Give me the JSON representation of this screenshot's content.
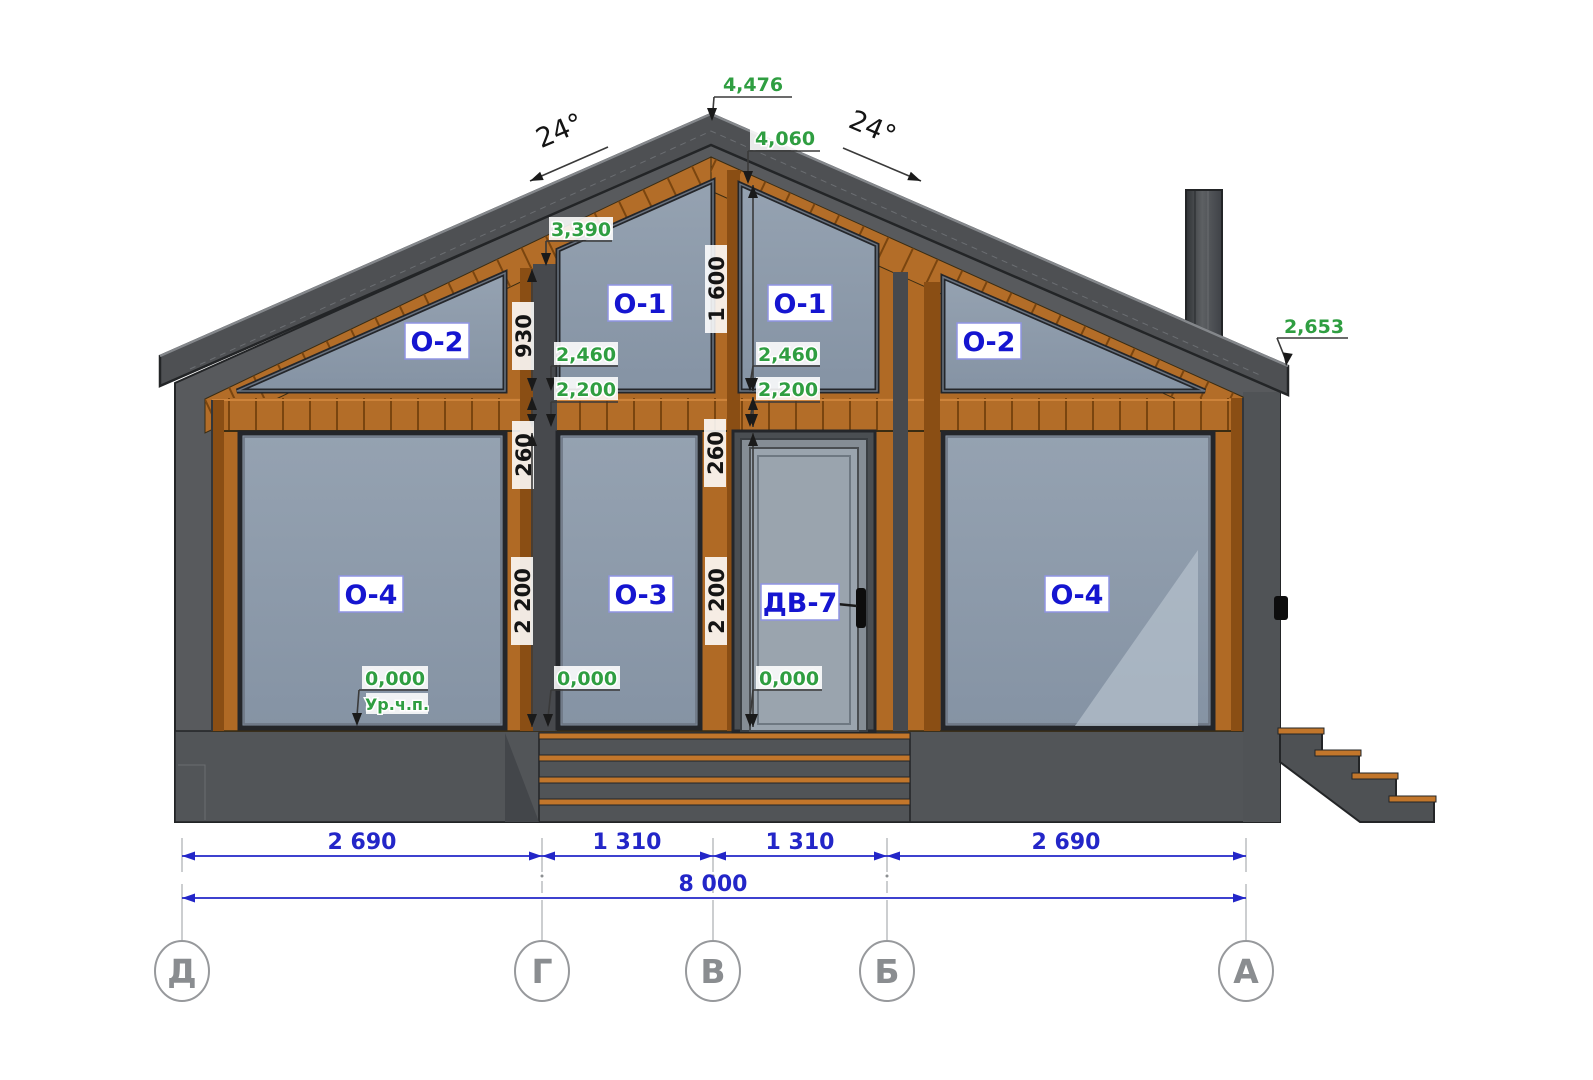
{
  "drawing": {
    "type": "house facade elevation",
    "slopes": {
      "left": "24°",
      "right": "24°"
    },
    "elevations": {
      "peak": "4,476",
      "ridge_under": "4,060",
      "gable_window_top": "3,390",
      "left_2460": "2,460",
      "left_2200": "2,200",
      "right_2460": "2,460",
      "right_2200": "2,200",
      "zero_left": "0,000",
      "zero_center_left": "0,000",
      "zero_center_right": "0,000",
      "eave_right": "2,653",
      "floor_note": "Ур.ч.п."
    },
    "vertical_dimensions": {
      "left_930": "930",
      "left_260": "260",
      "left_2200": "2 200",
      "right_1600": "1 600",
      "right_260": "260",
      "right_2200": "2 200"
    },
    "openings": {
      "o2_left": "О-2",
      "o1_left": "О-1",
      "o1_right": "О-1",
      "o2_right": "О-2",
      "o4_left": "О-4",
      "o3": "О-3",
      "door": "ДВ-7",
      "o4_right": "О-4"
    },
    "horizontal_dimensions": {
      "seg1": "2 690",
      "seg2": "1 310",
      "seg3": "1 310",
      "seg4": "2 690",
      "total": "8 000"
    },
    "axes": {
      "ax5": "Д",
      "ax4": "Г",
      "ax3": "В",
      "ax2": "Б",
      "ax1": "А"
    },
    "colors": {
      "wood": "#b36d28",
      "wood_dark": "#8a4e14",
      "wall_gray": "#585a5d",
      "glass": "#8e9bab",
      "dimension_blue": "#2326c8",
      "elevation_green": "#2f9e41",
      "label_blue": "#1515d0"
    }
  }
}
